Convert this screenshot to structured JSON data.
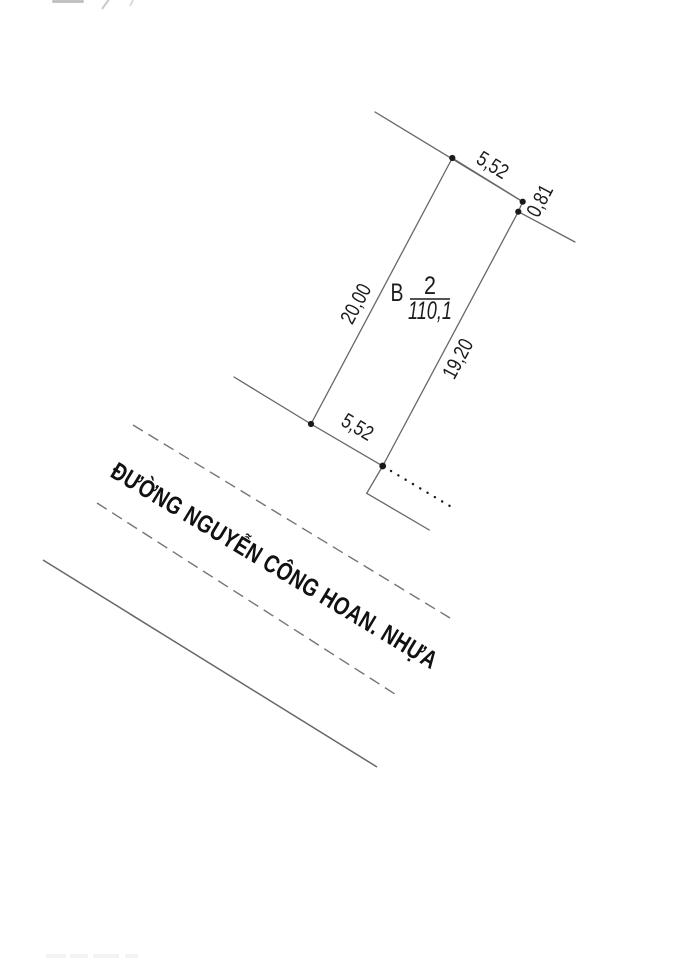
{
  "plan": {
    "parcel": {
      "block": "B",
      "number": "2",
      "area": "110,1",
      "dim_top": "5,52",
      "dim_corner": "0,81",
      "dim_left": "20,00",
      "dim_right": "19,20",
      "dim_bottom": "5,52"
    },
    "road_name": "ĐƯỜNG NGUYỄN CÔNG HOAN. NHỰA",
    "colors": {
      "line": "#676767",
      "dash": "#757575",
      "dot": "#1a1a1a",
      "text": "#1c1c1c"
    }
  }
}
